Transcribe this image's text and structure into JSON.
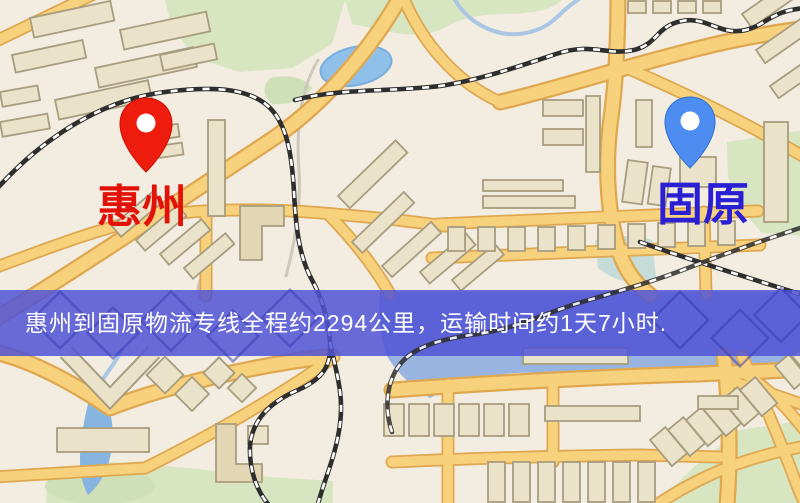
{
  "page": {
    "type": "logistics-route-map",
    "width": 800,
    "height": 503
  },
  "banner": {
    "text": "惠州到固原物流专线全程约2294公里，运输时间约1天7小时.",
    "bg_color": "rgba(80,84,214,0.85)",
    "text_color": "#ffffff"
  },
  "origin": {
    "name": "惠州",
    "pin_color": "#ee1c0c",
    "pin_stroke": "#c81104",
    "label_color": "#e31208"
  },
  "destination": {
    "name": "固原",
    "pin_color": "#4d8df2",
    "pin_stroke": "#2f6fd0",
    "label_color": "#2a1fd4"
  },
  "route": {
    "distance_km": "2294",
    "duration": "1天7小时"
  },
  "map_colors": {
    "background": "#f2ece1",
    "road_fill": "#f8d17c",
    "road_edge": "#dfa850",
    "building_fill": "#eae2c9",
    "green_area": "#d7e5c1",
    "water": "#9ab4e2",
    "railway": "#2e2e2e"
  }
}
